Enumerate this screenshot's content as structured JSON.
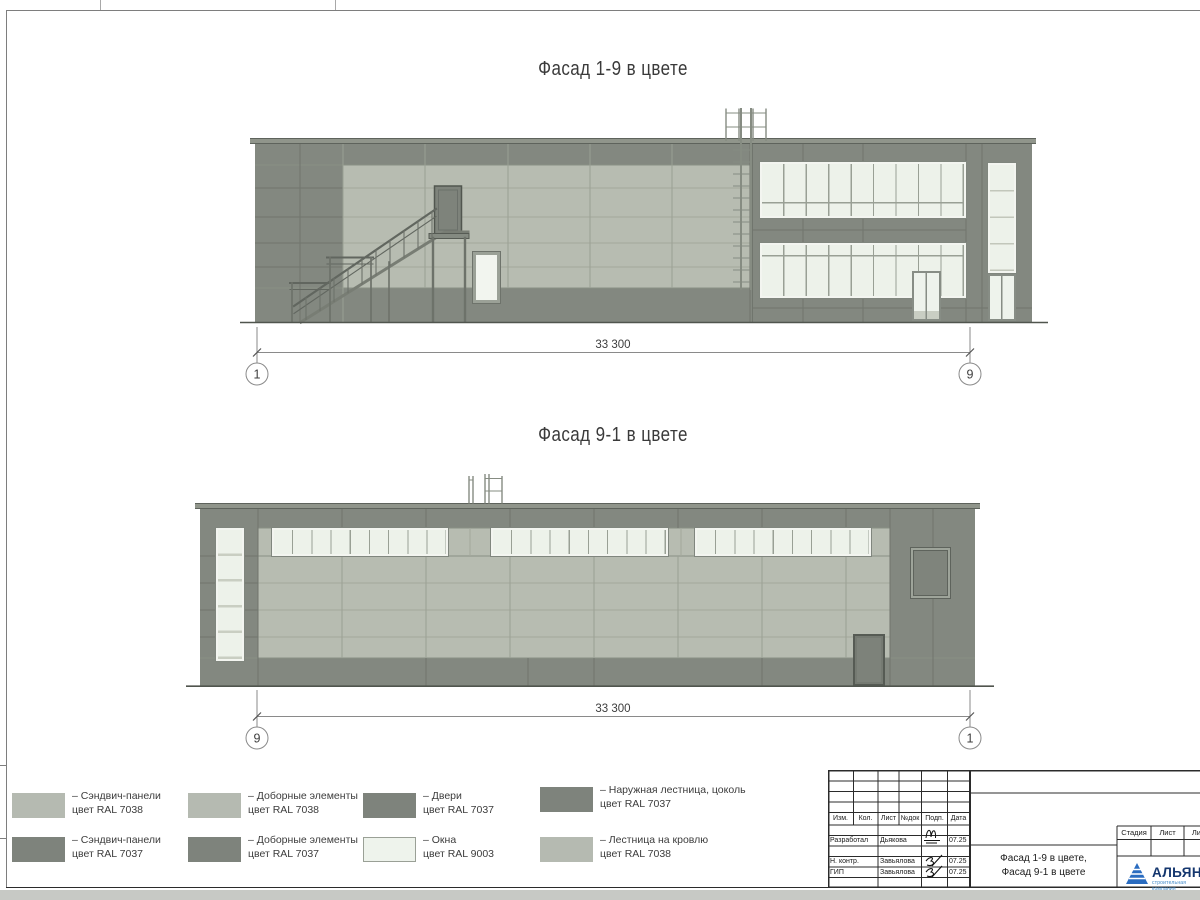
{
  "titles": {
    "facade1": "Фасад 1-9 в цвете",
    "facade2": "Фасад 9-1 в цвете"
  },
  "dim1": {
    "value": "33 300",
    "left_axis": "1",
    "right_axis": "9"
  },
  "dim2": {
    "value": "33 300",
    "left_axis": "9",
    "right_axis": "1"
  },
  "legend": {
    "items": [
      {
        "line1": "– Сэндвич-панели",
        "line2": "цвет RAL 7038",
        "color": "#b5bab1"
      },
      {
        "line1": "– Сэндвич-панели",
        "line2": "цвет RAL 7037",
        "color": "#7e837c"
      },
      {
        "line1": "– Доборные элементы",
        "line2": "цвет RAL 7038",
        "color": "#b5bab1"
      },
      {
        "line1": "– Доборные элементы",
        "line2": "цвет RAL 7037",
        "color": "#7e837c"
      },
      {
        "line1": "– Двери",
        "line2": "цвет RAL 7037",
        "color": "#7e837c"
      },
      {
        "line1": "– Окна",
        "line2": "цвет RAL 9003",
        "color": "#eef3ec"
      },
      {
        "line1": "– Наружная лестница, цоколь",
        "line2": "цвет RAL 7037",
        "color": "#7e837c"
      },
      {
        "line1": "– Лестница на кровлю",
        "line2": "цвет RAL 7038",
        "color": "#b5bab1"
      }
    ]
  },
  "titleblock": {
    "col_headers": [
      "Изм.",
      "Кол.",
      "Лист",
      "№док",
      "Подп.",
      "Дата"
    ],
    "rows": [
      {
        "role": "Разработал",
        "name": "Дьякова",
        "date": "07.25"
      },
      {
        "role": "Н. контр.",
        "name": "Завьялова",
        "date": "07.25"
      },
      {
        "role": "ГИП",
        "name": "Завьялова",
        "date": "07.25"
      }
    ],
    "doc_line1": "Фасад 1-9 в цвете,",
    "doc_line2": "Фасад 9-1 в цвете",
    "stage": "Стадия",
    "sheet": "Лист",
    "sheets": "Листов",
    "logo": "АЛЬЯНС",
    "logo_sub": "строительная компания"
  },
  "colors": {
    "ral7038": "#b5bab1",
    "ral7037": "#7e837c",
    "ral9003": "#eef3ec",
    "logo_blue": "#2a6cc0"
  }
}
